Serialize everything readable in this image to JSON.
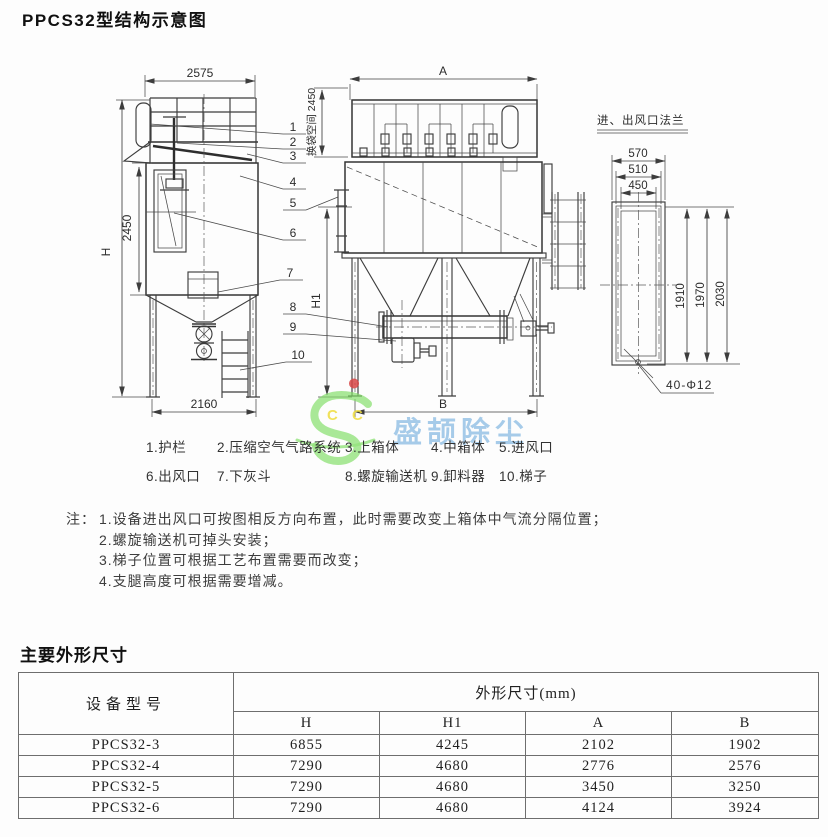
{
  "page": {
    "title": "PPCS32型结构示意图",
    "dimensions_title": "主要外形尺寸"
  },
  "drawing": {
    "side_view": {
      "top_width": "2575",
      "body_height": "2450",
      "overall_height": "H",
      "base_width": "2160",
      "bag_space": "换袋空间 2450"
    },
    "front_view": {
      "top_width": "A",
      "base_width": "B",
      "support_height": "H1"
    },
    "flange_detail": {
      "title": "进、出风口法兰",
      "outer_width": "570",
      "mid_width": "510",
      "inner_width": "450",
      "inner_height": "1910",
      "mid_height": "1970",
      "outer_height": "2030",
      "bolt_holes": "40-Φ12"
    },
    "part_numbers": [
      "1",
      "2",
      "3",
      "4",
      "5",
      "6",
      "7",
      "8",
      "9",
      "10"
    ]
  },
  "legend": {
    "items": [
      "1.护栏",
      "2.压缩空气气路系统",
      "3.上箱体",
      "4.中箱体",
      "5.进风口",
      "6.出风口",
      "7.下灰斗",
      "8.螺旋输送机",
      "9.卸料器",
      "10.梯子"
    ]
  },
  "notes": {
    "prefix": "注：",
    "items": [
      "1.设备进出风口可按图相反方向布置，此时需要改变上箱体中气流分隔位置；",
      "2.螺旋输送机可掉头安装；",
      "3.梯子位置可根据工艺布置需要而改变；",
      "4.支腿高度可根据需要增减。"
    ]
  },
  "table": {
    "model_header": "设备型号",
    "group_header": "外形尺寸(mm)",
    "columns": [
      "H",
      "H1",
      "A",
      "B"
    ],
    "rows": [
      {
        "model": "PPCS32-3",
        "values": [
          "6855",
          "4245",
          "2102",
          "1902"
        ]
      },
      {
        "model": "PPCS32-4",
        "values": [
          "7290",
          "4680",
          "2776",
          "2576"
        ]
      },
      {
        "model": "PPCS32-5",
        "values": [
          "7290",
          "4680",
          "3450",
          "3250"
        ]
      },
      {
        "model": "PPCS32-6",
        "values": [
          "7290",
          "4680",
          "4124",
          "3924"
        ]
      }
    ]
  },
  "watermark": {
    "text": "盛颉除尘",
    "letters": [
      "C",
      "C"
    ],
    "logo_color": "#82df68",
    "text_color": "#5a9fd8",
    "dot_color": "#d84545",
    "letter_color": "#efdd3e"
  }
}
